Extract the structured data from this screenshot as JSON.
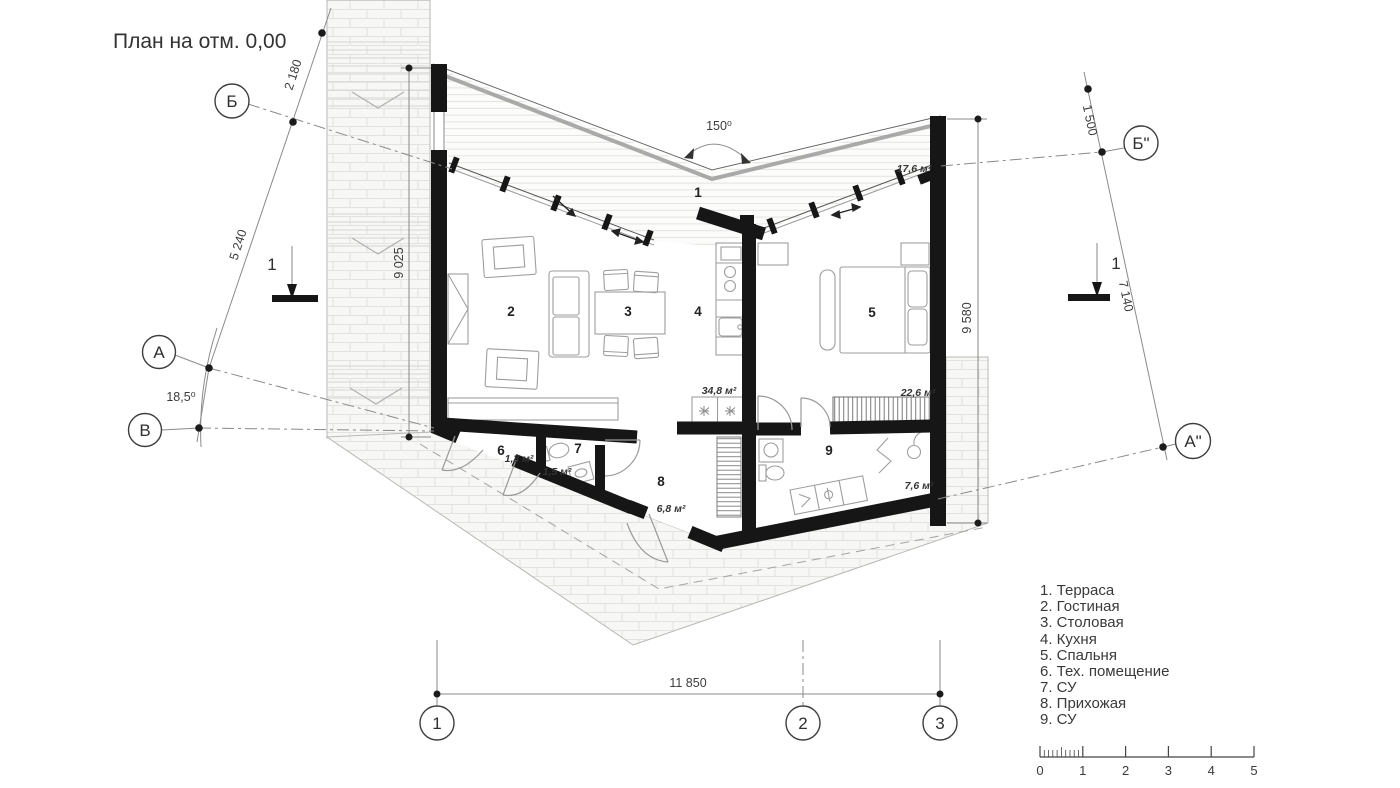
{
  "title": "План на отм. 0,00",
  "angles": {
    "top": "150⁰",
    "left": "18,5⁰"
  },
  "axis_markers": {
    "left": [
      "Б",
      "А",
      "В"
    ],
    "right": [
      "Б\"",
      "А\""
    ],
    "bottom": [
      "1",
      "2",
      "3"
    ]
  },
  "section_marks": {
    "left": "1",
    "right": "1"
  },
  "dimensions": {
    "left_diag_upper": "2 180",
    "left_diag_lower": "5 240",
    "left_vertical": "9 025",
    "right_diag_upper": "1 500",
    "right_diag_lower": "7 140",
    "right_vertical": "9 580",
    "bottom_span": "11 850"
  },
  "rooms": [
    {
      "num": "1",
      "area": "17,6 м²"
    },
    {
      "num": "2"
    },
    {
      "num": "3"
    },
    {
      "num": "4",
      "area": "34,8 м²"
    },
    {
      "num": "5",
      "area": "22,6 м²"
    },
    {
      "num": "6",
      "area": "1,3 м²"
    },
    {
      "num": "7",
      "area": "1,5 м²"
    },
    {
      "num": "8",
      "area": "6,8 м²"
    },
    {
      "num": "9",
      "area": "7,6 м²"
    }
  ],
  "legend": [
    "1. Терраса",
    "2. Гостиная",
    "3. Столовая",
    "4. Кухня",
    "5. Спальня",
    "6. Тех. помещение",
    "7. СУ",
    "8. Прихожая",
    "9. СУ"
  ],
  "scale_bar": [
    "0",
    "1",
    "2",
    "3",
    "4",
    "5"
  ]
}
